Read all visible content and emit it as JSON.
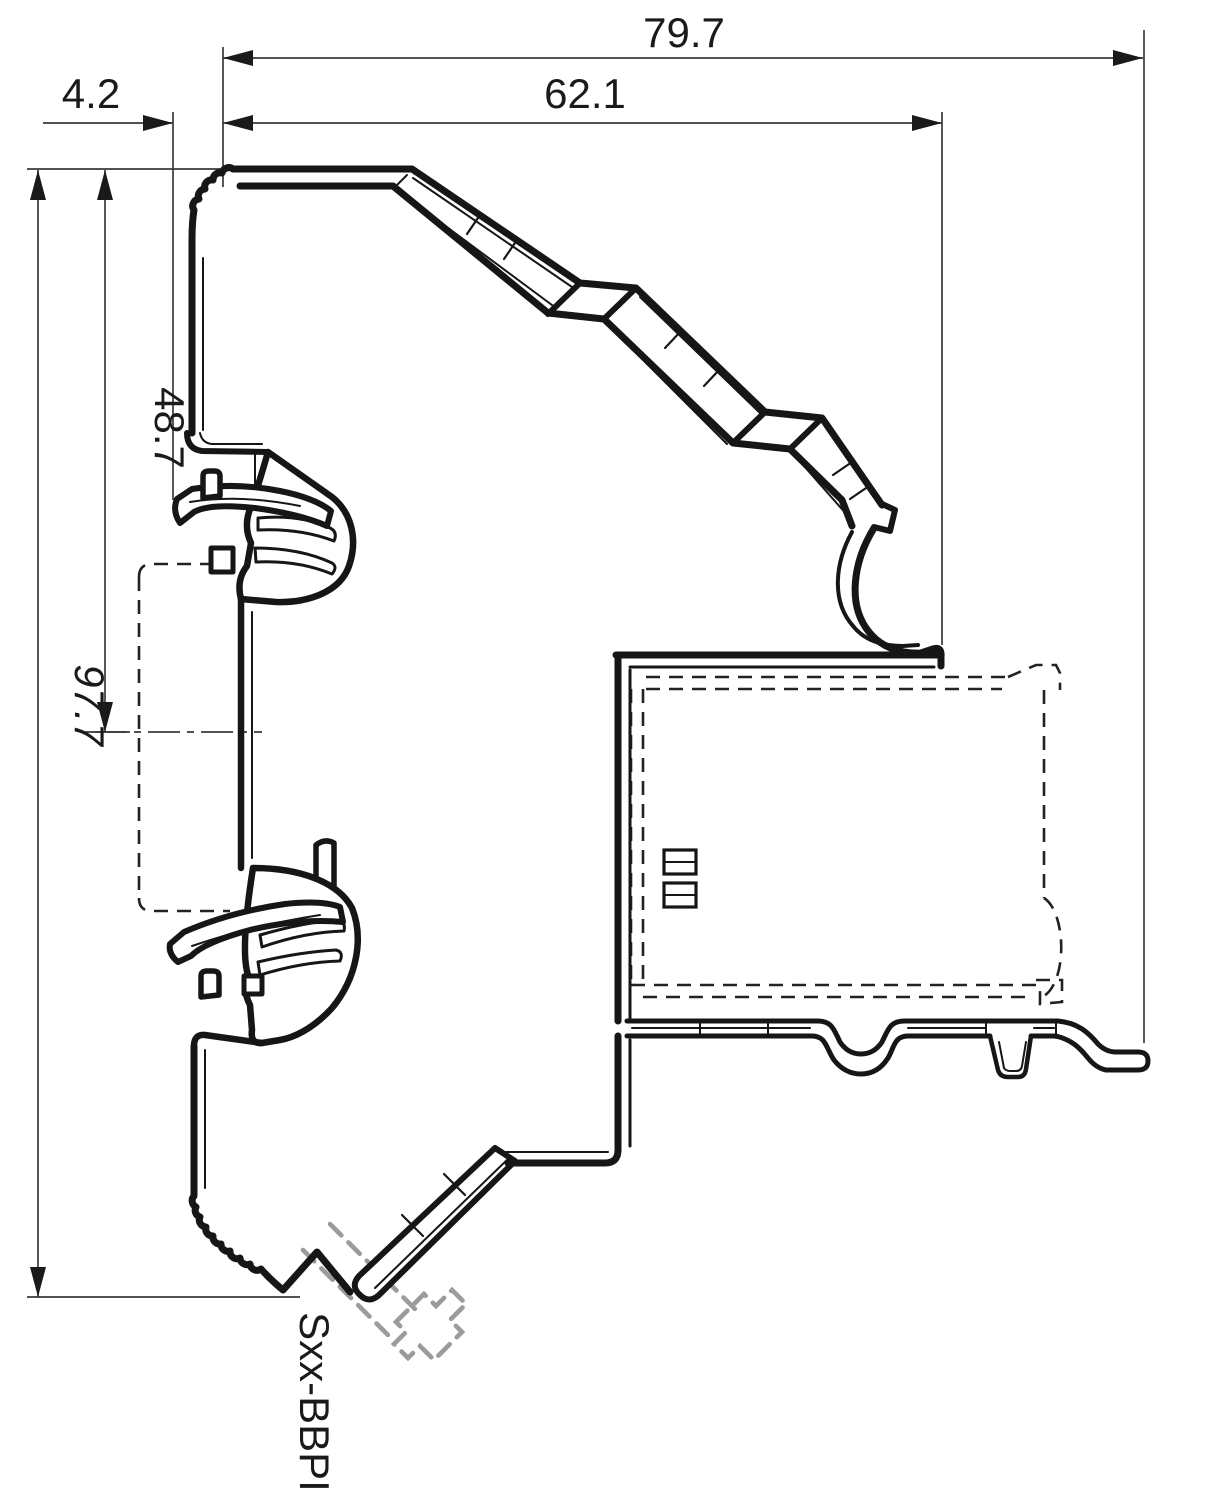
{
  "drawing": {
    "title": "DIN-rail device side profile dimension drawing",
    "dimensions": {
      "overall_depth": "79.7",
      "body_depth": "62.1",
      "clip_protrusion": "4.2",
      "rail_center_height": "48.7",
      "overall_height": "97.7"
    },
    "part_label": "Sxx-BBPI",
    "colors": {
      "line": "#161616",
      "thin_line": "#3a3a3a",
      "phantom_gray": "#9b9b9b",
      "background": "#ffffff"
    }
  }
}
